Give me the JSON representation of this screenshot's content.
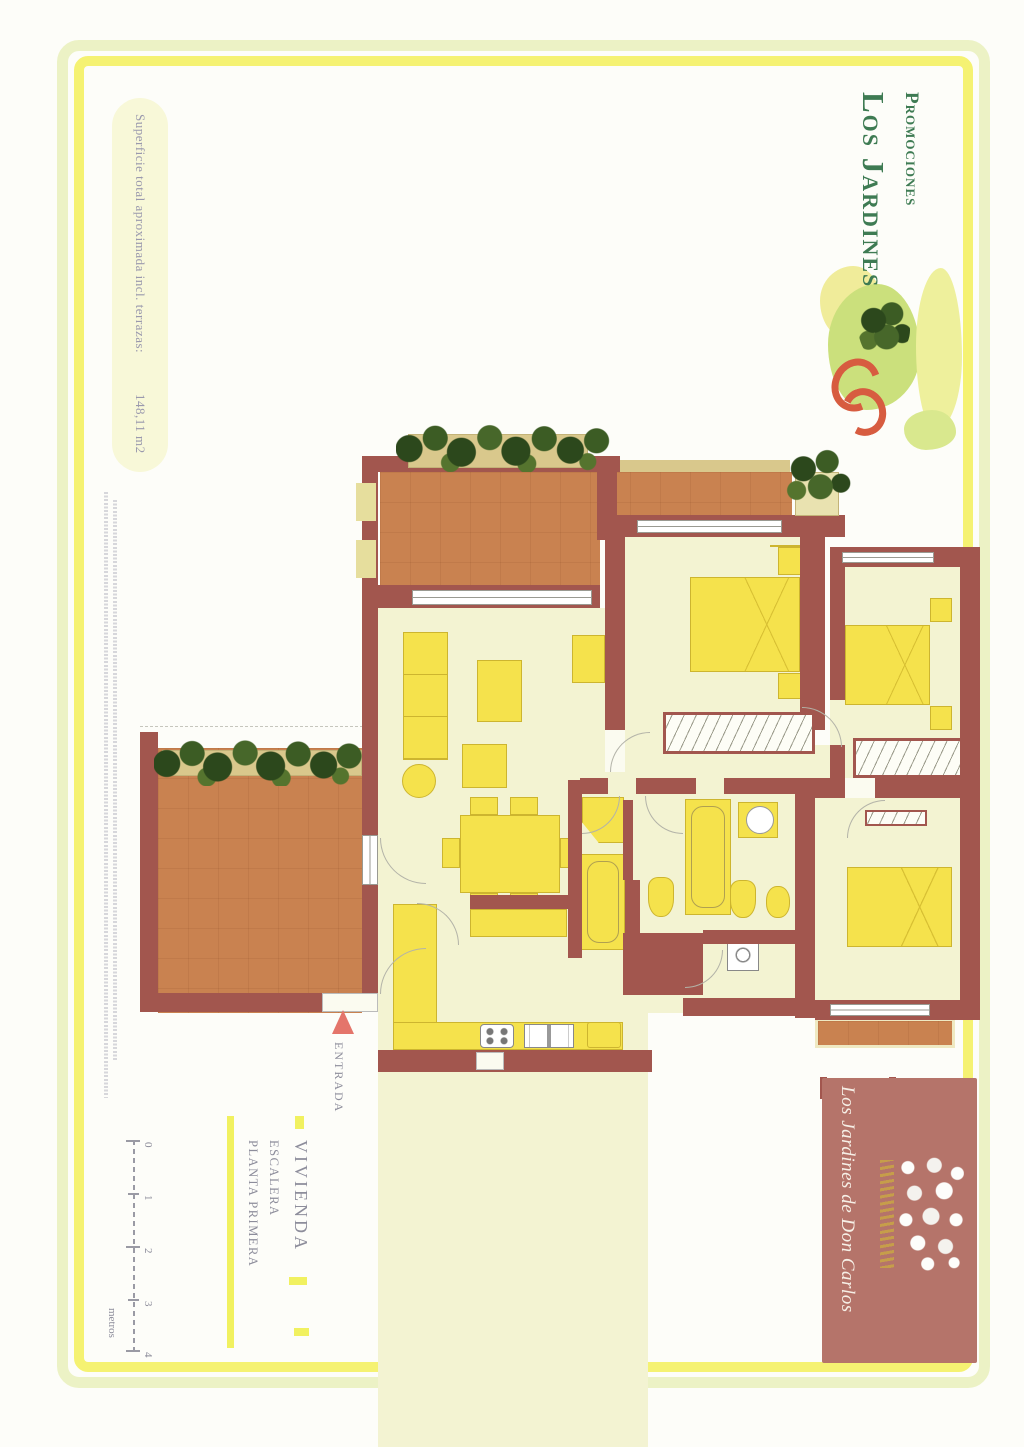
{
  "brand": {
    "line1": "Promociones",
    "line2": "Los Jardines",
    "color": "#3e7b53"
  },
  "surface_note": {
    "label": "Superficie total aproximada incl. terrazas:",
    "value": "148,11 m2"
  },
  "entrance_label": "ENTRADA",
  "legend": {
    "vivienda": "VIVIENDA",
    "escalera": "ESCALERA",
    "planta": "PLANTA PRIMERA"
  },
  "scale_bar": {
    "ticks": [
      "0",
      "1",
      "2",
      "3",
      "4"
    ],
    "unit": "metros"
  },
  "footer_box": {
    "title": "Los Jardines de Don Carlos",
    "bg": "#b5746a"
  },
  "palette": {
    "wall": "#a2564e",
    "terrace_floor": "#c98250",
    "room_floor": "#f3f3d2",
    "furniture": "#f5e24c",
    "plant_green": "#2c481c",
    "frame_outer": "#ecf2c5",
    "frame_inner": "#f5f272",
    "entrance_arrow": "#e4756b",
    "label_gray": "#8d8d9b"
  }
}
